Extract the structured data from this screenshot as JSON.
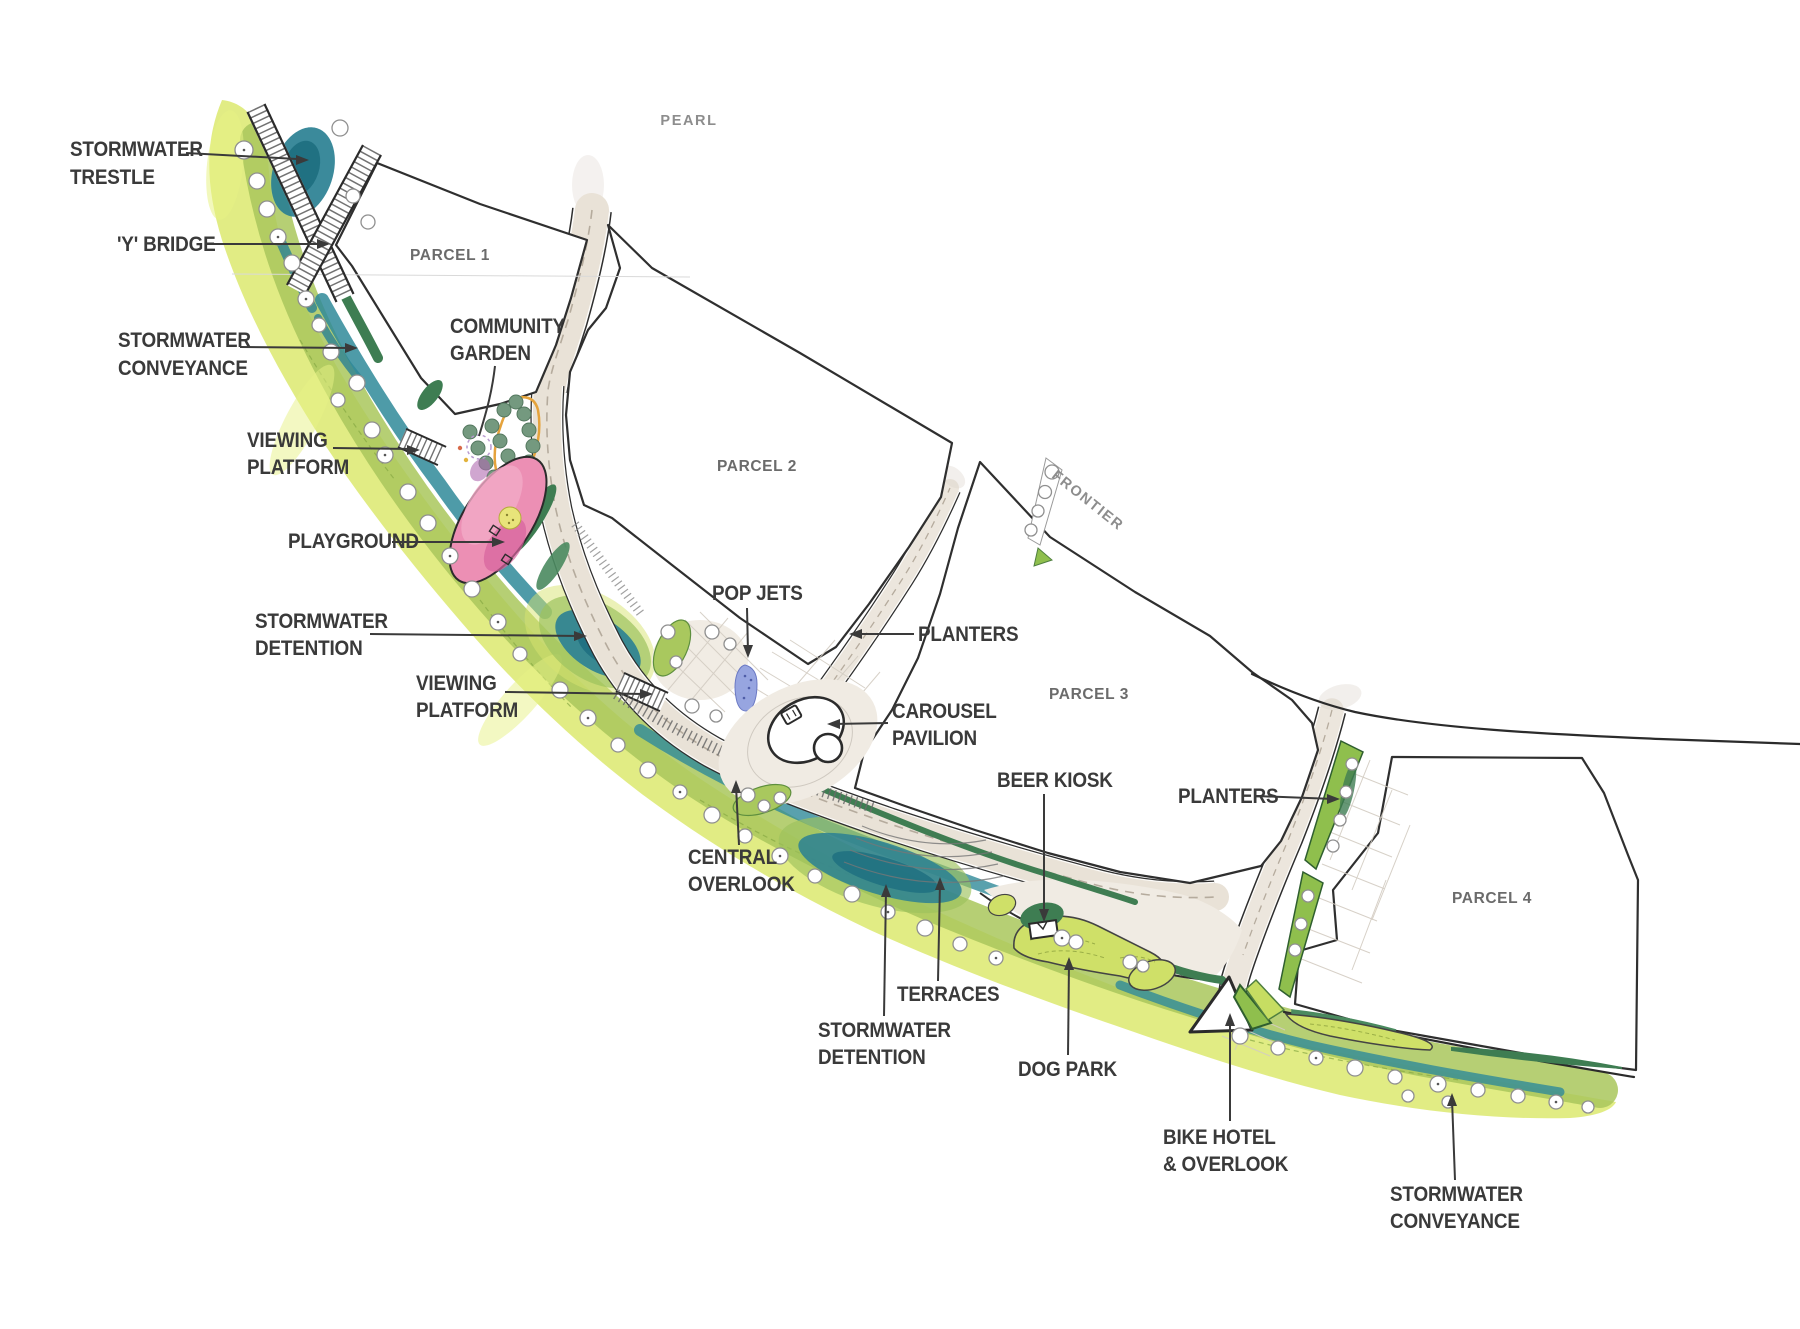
{
  "map": {
    "streets": {
      "pearl": "PEARL",
      "frontier": "FRONTIER"
    },
    "parcels": {
      "parcel1": "PARCEL 1",
      "parcel2": "PARCEL 2",
      "parcel3": "PARCEL 3",
      "parcel4": "PARCEL 4"
    },
    "labels": {
      "stormwater_trestle": {
        "l1": "STORMWATER",
        "l2": "TRESTLE"
      },
      "y_bridge": {
        "l1": "'Y' BRIDGE"
      },
      "stormwater_conveyance_nw": {
        "l1": "STORMWATER",
        "l2": "CONVEYANCE"
      },
      "viewing_platform_upper": {
        "l1": "VIEWING",
        "l2": "PLATFORM"
      },
      "community_garden": {
        "l1": "COMMUNITY",
        "l2": "GARDEN"
      },
      "playground": {
        "l1": "PLAYGROUND"
      },
      "stormwater_detention_upper": {
        "l1": "STORMWATER",
        "l2": "DETENTION"
      },
      "viewing_platform_lower": {
        "l1": "VIEWING",
        "l2": "PLATFORM"
      },
      "pop_jets": {
        "l1": "POP JETS"
      },
      "planters_mid": {
        "l1": "PLANTERS"
      },
      "carousel_pavilion": {
        "l1": "CAROUSEL",
        "l2": "PAVILION"
      },
      "central_overlook": {
        "l1": "CENTRAL",
        "l2": "OVERLOOK"
      },
      "terraces": {
        "l1": "TERRACES"
      },
      "stormwater_detention_lower": {
        "l1": "STORMWATER",
        "l2": "DETENTION"
      },
      "beer_kiosk": {
        "l1": "BEER KIOSK"
      },
      "dog_park": {
        "l1": "DOG PARK"
      },
      "planters_east": {
        "l1": "PLANTERS"
      },
      "bike_hotel": {
        "l1": "BIKE HOTEL",
        "l2": "& OVERLOOK"
      },
      "stormwater_conveyance_se": {
        "l1": "STORMWATER",
        "l2": "CONVEYANCE"
      }
    },
    "colors": {
      "ink": "#3a3a3a",
      "parcel_line": "#2f2f2f",
      "band_yellow": "#dce96f",
      "band_green": "#a9c75c",
      "dark_green": "#3e7d52",
      "lawn_green": "#cfe068",
      "water_teal": "#2a8093",
      "water_deep": "#1e6e80",
      "path_cream": "#e9e2d7",
      "plaza_paving": "#f0ebe3",
      "playground_pink": "#ec8fb4",
      "pop_jets_blue": "#97a5e0",
      "garden_orange": "#e5a33c",
      "garden_tree": "#74997f"
    }
  }
}
